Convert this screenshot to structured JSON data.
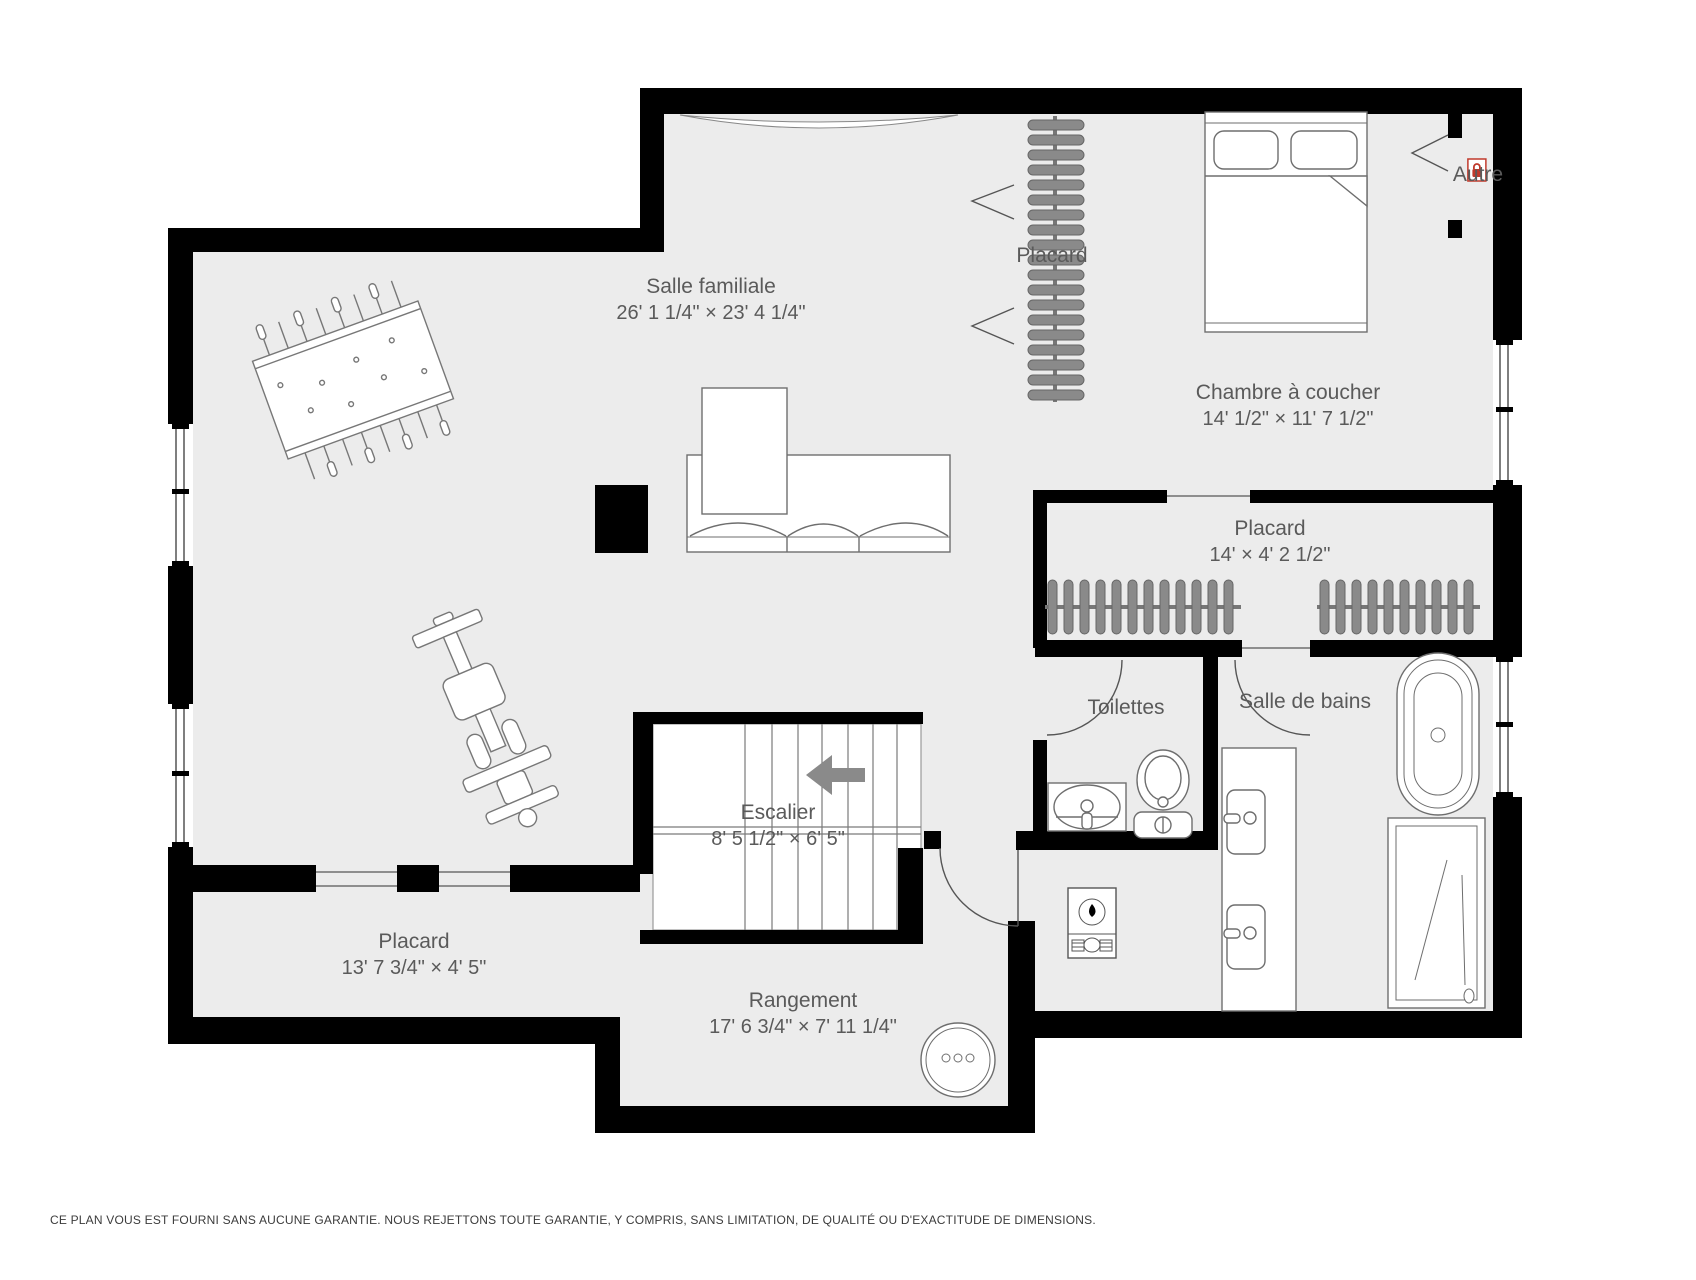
{
  "colors": {
    "floor": "#ececec",
    "wall": "#000000",
    "furniture_stroke": "#6e6e6e",
    "hanger_fill": "#8a8a8a",
    "label_text": "#5a5a5a",
    "accent_red": "#c0392b",
    "arrow_gray": "#8a8a8a"
  },
  "icons": {
    "autre_badge": "lock-icon",
    "stair_direction": "arrow-left-icon"
  },
  "rooms": {
    "salle_familiale": {
      "name": "Salle familiale",
      "dims": "26' 1 1/4\" × 23' 4 1/4\""
    },
    "placard_haut": {
      "name": "Placard"
    },
    "chambre": {
      "name": "Chambre à coucher",
      "dims": "14' 1/2\" × 11' 7 1/2\""
    },
    "autre": {
      "name": "Autre"
    },
    "placard_14": {
      "name": "Placard",
      "dims": "14' × 4' 2 1/2\""
    },
    "toilettes": {
      "name": "Toilettes"
    },
    "salle_de_bains": {
      "name": "Salle de bains"
    },
    "escalier": {
      "name": "Escalier",
      "dims": "8' 5 1/2\" × 6' 5\""
    },
    "placard_bas": {
      "name": "Placard",
      "dims": "13' 7 3/4\" × 4' 5\""
    },
    "rangement": {
      "name": "Rangement",
      "dims": "17' 6 3/4\" × 7' 11 1/4\""
    }
  },
  "page": {
    "disclaimer": "CE PLAN VOUS EST FOURNI SANS AUCUNE GARANTIE. NOUS REJETTONS TOUTE GARANTIE, Y COMPRIS, SANS LIMITATION, DE QUALITÉ OU D'EXACTITUDE DE DIMENSIONS."
  }
}
